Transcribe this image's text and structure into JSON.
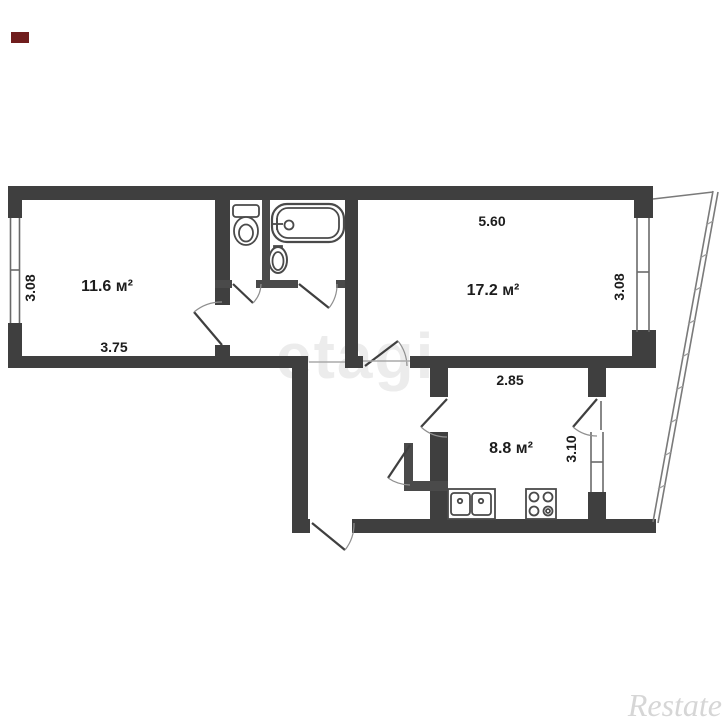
{
  "floorplan": {
    "rooms": [
      {
        "id": "living-room",
        "area": "11.6 м²",
        "width": "3.75",
        "height": "3.08"
      },
      {
        "id": "bedroom",
        "area": "17.2 м²",
        "width": "5.60",
        "height": "3.08"
      },
      {
        "id": "kitchen",
        "area": "8.8 м²",
        "width": "2.85",
        "height": "3.10"
      }
    ],
    "fixtures": [
      "toilet",
      "bathtub",
      "sink",
      "kitchen-sink",
      "stove"
    ],
    "watermark_center": "etagi",
    "watermark_corner": "Restate",
    "colors": {
      "wall": "#3f3f3f",
      "background": "#ffffff",
      "dimension_text": "#1c1c1c",
      "watermark_center": "#ececec",
      "watermark_corner": "#d6d6d6",
      "corner_mark": "#701d1d"
    }
  }
}
